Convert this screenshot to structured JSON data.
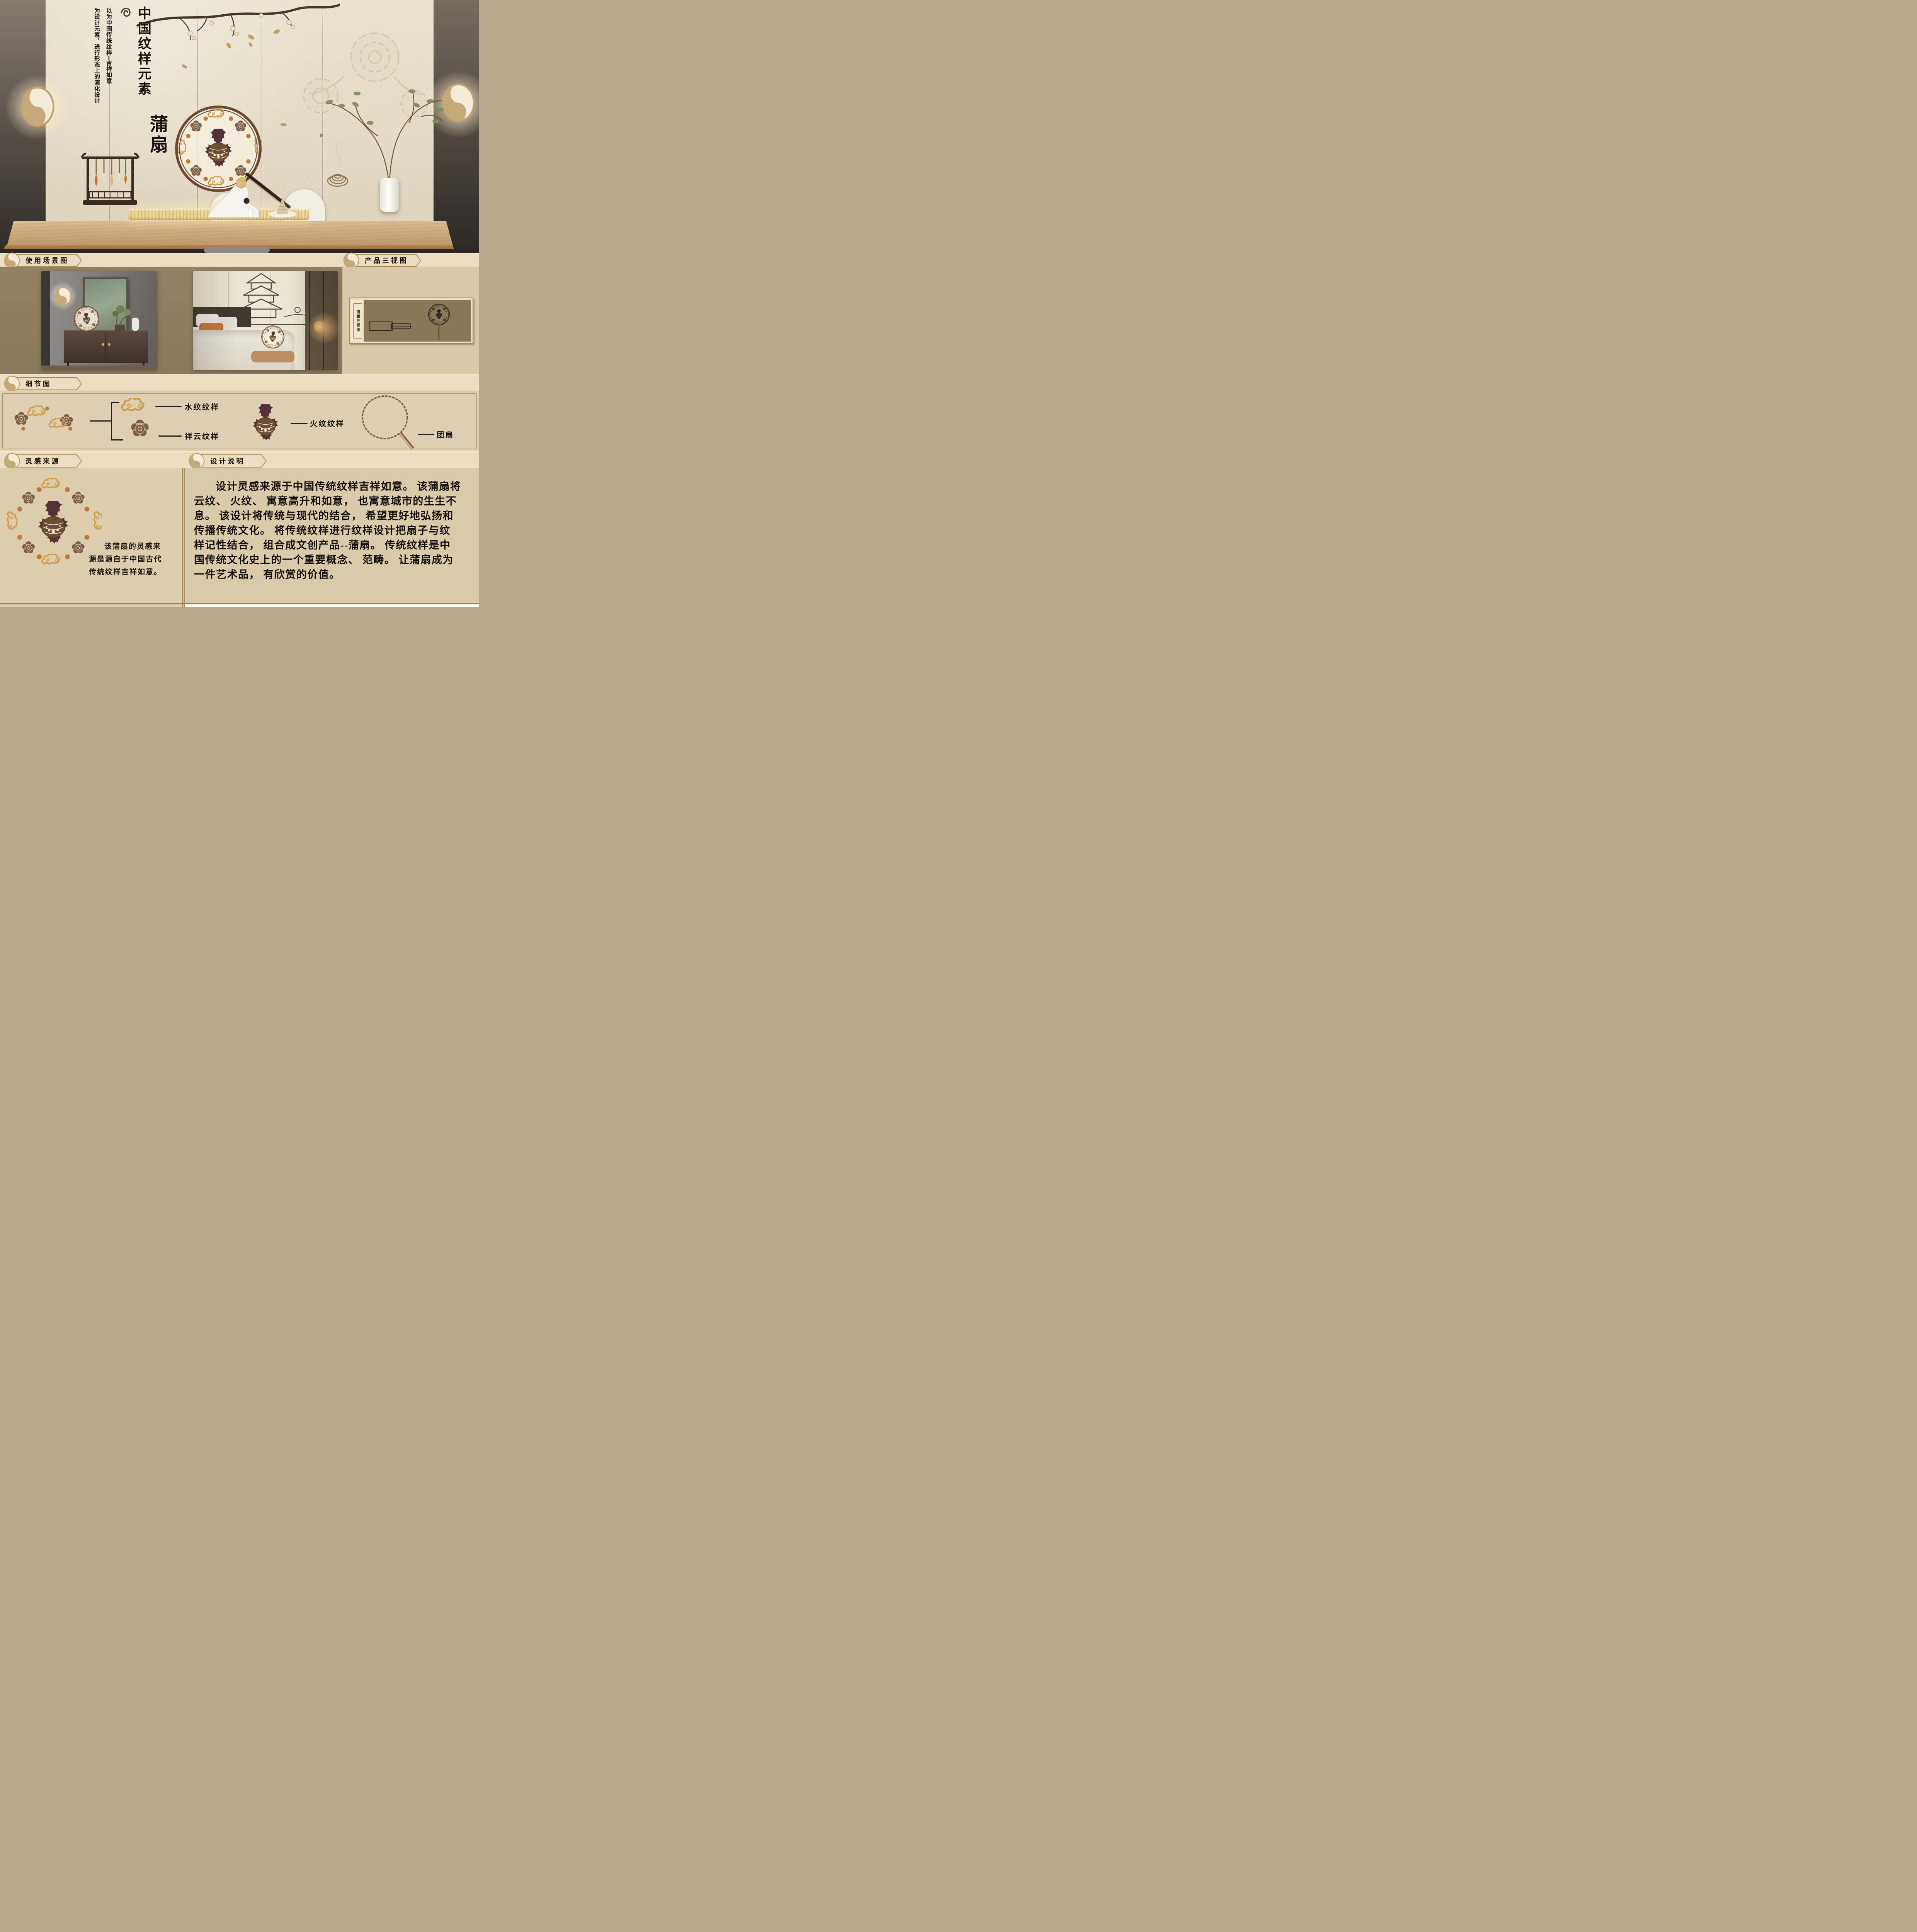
{
  "hero": {
    "annotation_right_column": "以为中国传统纹样--吉祥如意",
    "annotation_left_column": "为设计元素，进行形态上的演化设计",
    "title_vertical": "中国纹样元素",
    "product_name": "蒲扇"
  },
  "badges": {
    "scene": "使用场景图",
    "three_view": "产品三视图",
    "details": "细节图",
    "inspiration": "灵感来源",
    "description": "设计说明"
  },
  "three_view_panel": {
    "side_label": "蒲扇三视图"
  },
  "details": {
    "water_label": "水纹纹样",
    "cloud_label": "祥云纹样",
    "fire_label": "火纹纹样",
    "fan_label": "团扇"
  },
  "inspiration": {
    "lines": [
      "该蒲扇的灵感来",
      "源是源自于中国古代",
      "传统纹样吉祥如意。"
    ]
  },
  "description": {
    "lines": [
      "设计灵感来源于中国传统纹样吉祥如意。 该蒲扇将",
      "云纹、 火纹、 寓意高升和如意， 也寓意城市的生生不",
      "息。 该设计将传统与现代的结合， 希望更好地弘扬和",
      "传播传统文化。 将传统纹样进行纹样设计把扇子与纹",
      "样记性结合， 组合成文创产品--蒲扇。 传统纹样是中",
      "国传统文化史上的一个重要概念、 范畴。 让蒲扇成为",
      "一件艺术品， 有欣赏的价值。"
    ]
  },
  "colors": {
    "band_cream": "#ecdcc0",
    "badge_tan": "#a98b55",
    "scene_khaki": "#8e7d5f",
    "panel_beige": "#ddcfb1",
    "fan_rim_brown": "#6d4a33",
    "flame_maroon": "#57313a",
    "gold_accent": "#cf9c4e",
    "orange_dot": "#c17a3c",
    "text_ink": "#15110c"
  }
}
